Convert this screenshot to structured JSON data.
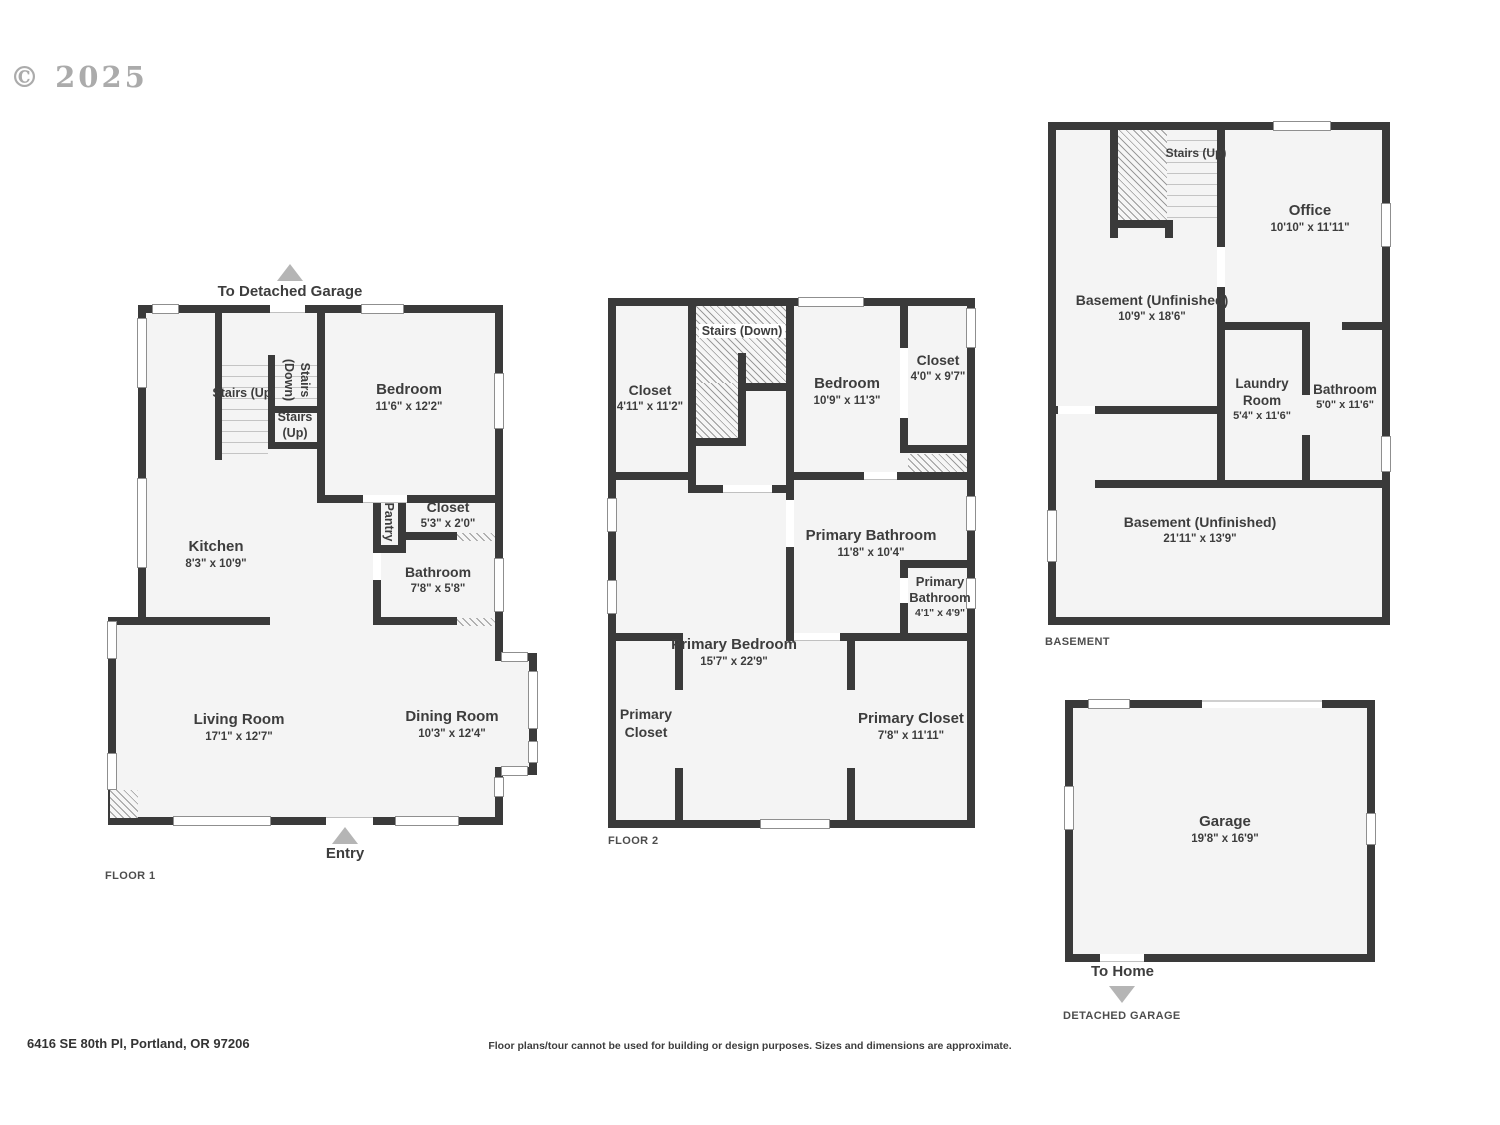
{
  "copyright": "© 2025",
  "colors": {
    "wall": "#3a3a3a",
    "room_fill": "#f4f4f4",
    "label": "#3d3d3d",
    "arrow": "#b5b5b5"
  },
  "floor1": {
    "caption": "FLOOR 1",
    "to_garage_label": "To Detached Garage",
    "entry_label": "Entry",
    "rooms": {
      "stairs_up_main": {
        "name": "Stairs (Up)"
      },
      "stairs_down": {
        "name": "Stairs (Down)"
      },
      "stairs_up_small": {
        "name": "Stairs (Up)"
      },
      "bedroom": {
        "name": "Bedroom",
        "dims": "11'6\" x 12'2\""
      },
      "closet": {
        "name": "Closet",
        "dims": "5'3\" x 2'0\""
      },
      "pantry": {
        "name": "Pantry"
      },
      "kitchen": {
        "name": "Kitchen",
        "dims": "8'3\" x 10'9\""
      },
      "bathroom": {
        "name": "Bathroom",
        "dims": "7'8\" x 5'8\""
      },
      "living_room": {
        "name": "Living Room",
        "dims": "17'1\" x 12'7\""
      },
      "dining_room": {
        "name": "Dining Room",
        "dims": "10'3\" x 12'4\""
      }
    }
  },
  "floor2": {
    "caption": "FLOOR 2",
    "rooms": {
      "stairs_down": {
        "name": "Stairs (Down)"
      },
      "closet_left": {
        "name": "Closet",
        "dims": "4'11\" x 11'2\""
      },
      "bedroom": {
        "name": "Bedroom",
        "dims": "10'9\" x 11'3\""
      },
      "closet_right": {
        "name": "Closet",
        "dims": "4'0\" x 9'7\""
      },
      "primary_bathroom": {
        "name": "Primary Bathroom",
        "dims": "11'8\" x 10'4\""
      },
      "primary_bathroom_small": {
        "name": "Primary Bathroom",
        "dims": "4'1\" x 4'9\""
      },
      "primary_bedroom": {
        "name": "Primary Bedroom",
        "dims": "15'7\" x 22'9\""
      },
      "primary_closet_left": {
        "name": "Primary Closet"
      },
      "primary_closet_right": {
        "name": "Primary Closet",
        "dims": "7'8\" x 11'11\""
      }
    }
  },
  "basement": {
    "caption": "BASEMENT",
    "rooms": {
      "stairs_up": {
        "name": "Stairs (Up)"
      },
      "office": {
        "name": "Office",
        "dims": "10'10\" x 11'11\""
      },
      "basement_upper": {
        "name": "Basement (Unfinished)",
        "dims": "10'9\" x 18'6\""
      },
      "laundry": {
        "name": "Laundry Room",
        "dims": "5'4\" x 11'6\""
      },
      "bathroom": {
        "name": "Bathroom",
        "dims": "5'0\" x 11'6\""
      },
      "basement_lower": {
        "name": "Basement (Unfinished)",
        "dims": "21'11\" x 13'9\""
      }
    }
  },
  "garage": {
    "caption": "DETACHED GARAGE",
    "to_home_label": "To Home",
    "rooms": {
      "garage": {
        "name": "Garage",
        "dims": "19'8\" x 16'9\""
      }
    }
  },
  "footer": {
    "address": "6416 SE 80th Pl, Portland, OR 97206",
    "disclaimer": "Floor plans/tour cannot be used for building or design purposes. Sizes and dimensions are approximate."
  }
}
